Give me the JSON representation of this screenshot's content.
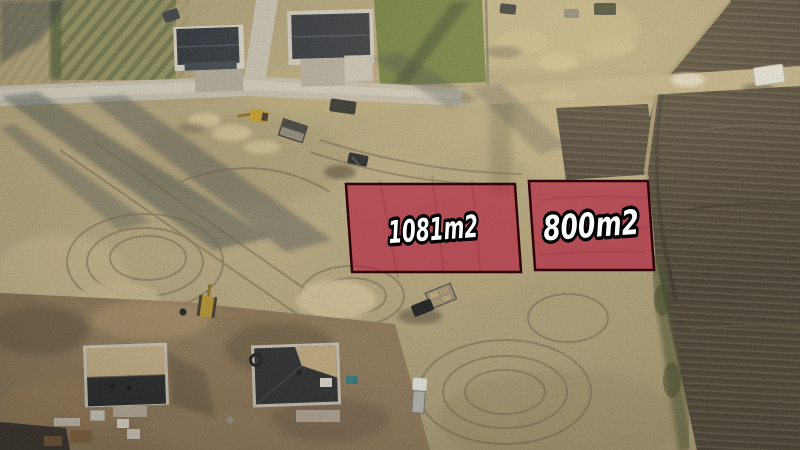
{
  "plots": [
    {
      "area_label": "1081m2"
    },
    {
      "area_label": "800m2"
    }
  ],
  "annotation": {
    "fill": "#b5123a",
    "fill_opacity": "0.58",
    "border": "#2e040a",
    "text_fill": "#ffffff",
    "text_outline": "#000000"
  }
}
